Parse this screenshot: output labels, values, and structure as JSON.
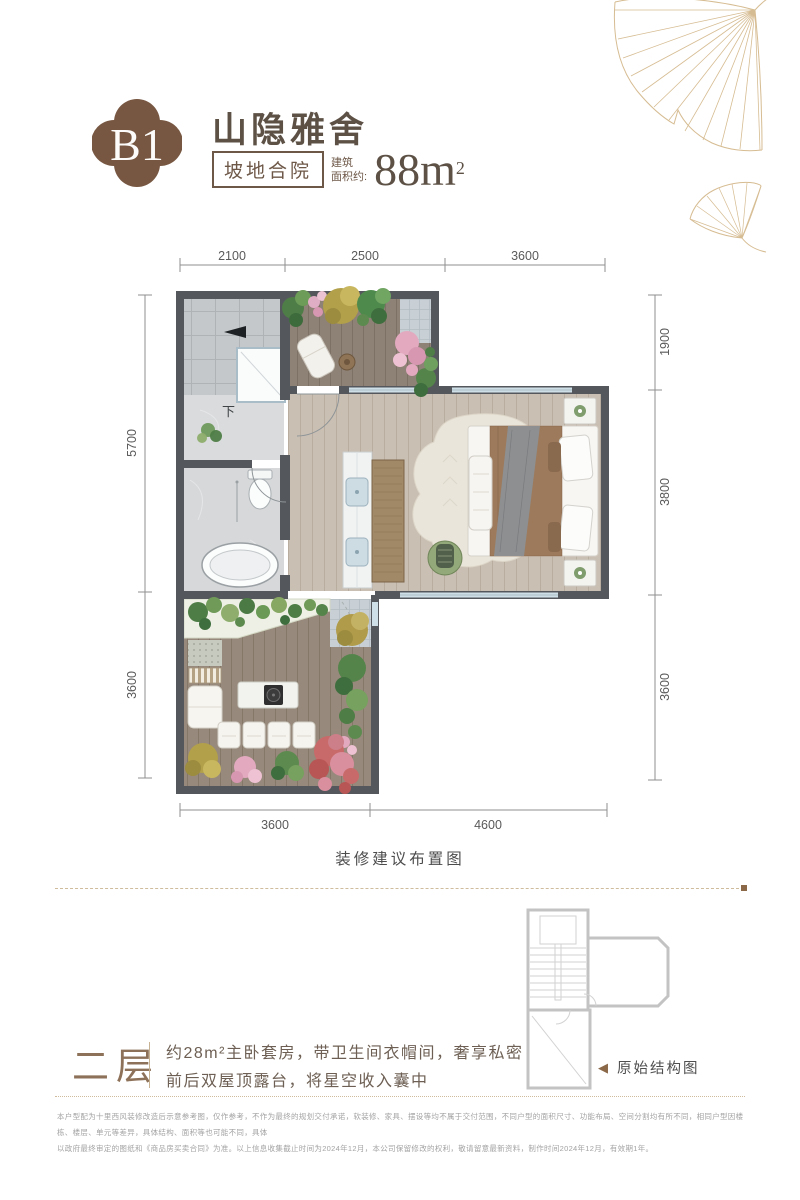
{
  "header": {
    "badge": "B1",
    "title": "山隐雅舍",
    "tag": "坡地合院",
    "area_label_line1": "建筑",
    "area_label_line2": "面积约:",
    "area_value": "88m",
    "area_sup": "2"
  },
  "floor_plan": {
    "caption": "装修建议布置图",
    "stairs_label": "下",
    "dims": {
      "top": [
        "2100",
        "2500",
        "3600"
      ],
      "left": [
        "5700",
        "3600"
      ],
      "right": [
        "1900",
        "3800",
        "3600"
      ],
      "bottom": [
        "3600",
        "4600"
      ]
    }
  },
  "structure": {
    "pointer": "◀",
    "label": "原始结构图"
  },
  "floor_section": {
    "floor_label": "二层",
    "desc_line1": "约28m²主卧套房，带卫生间衣帽间，奢享私密",
    "desc_line2": "前后双屋顶露台，将星空收入囊中"
  },
  "disclaimer": {
    "line1": "本户型配为十里西风装修改造后示意参考图，仅作参考，不作为最终的规划交付承诺，软装修、家具、摆设等均不属于交付范围，不同户型的面积尺寸、功能布局、空间分割均有所不同，相同户型因楼栋、楼层、单元等差异，具体结构、面积等也可能不同，具体",
    "line2": "以政府最终审定的图纸和《商品房买卖合同》为准。以上信息收集截止时间为2024年12月，本公司保留修改的权利，敬请留意最新资料，制作时间2024年12月，有效期1年。"
  },
  "colors": {
    "badge_brown": "#775741",
    "title_brown": "#5d5146",
    "tag_brown": "#6d5747",
    "accent_tan": "#cfbc9c",
    "wall_gray": "#54585c",
    "floor_label_brown": "#8d7158",
    "ginkgo_gold": "#d6bc92"
  }
}
